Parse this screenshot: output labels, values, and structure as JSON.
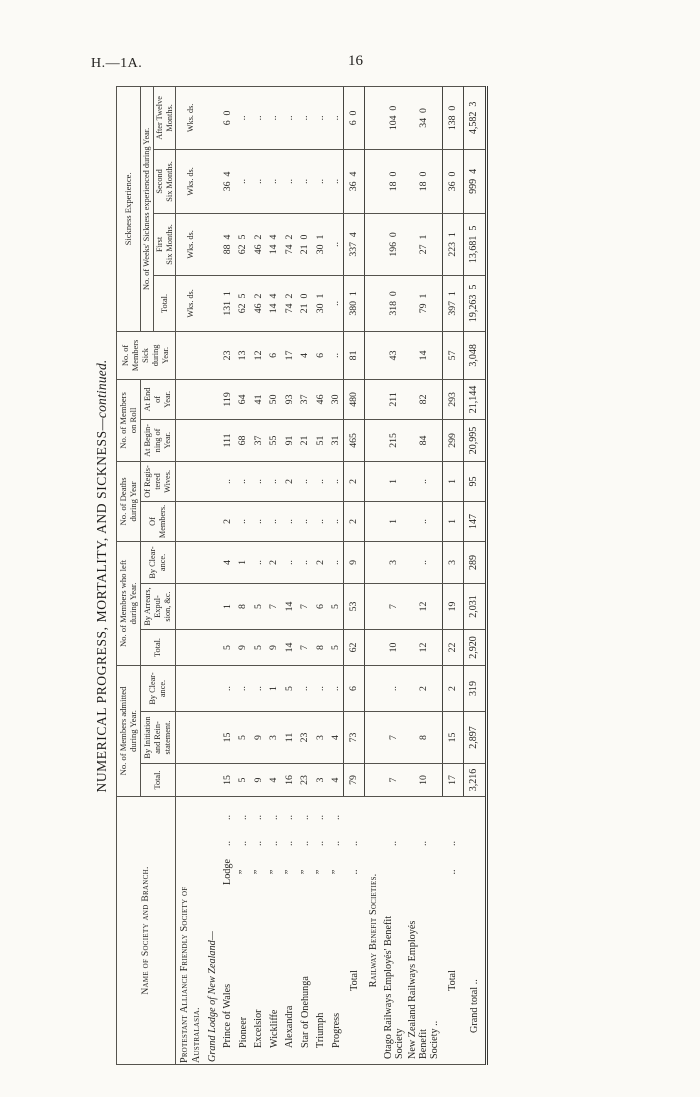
{
  "page": {
    "doc_ref": "H.—1A.",
    "page_number": "16"
  },
  "table": {
    "title_main": "NUMERICAL PROGRESS, MORTALITY, AND SICKNESS",
    "title_suffix": "—continued.",
    "headers": {
      "name": "Name of Society and Branch.",
      "admitted": {
        "group": "No. of Members admitted\nduring Year.",
        "cols": [
          "Total.",
          "By Initiation\nand Rein-\nstatement.",
          "By Clear-\nance."
        ]
      },
      "left": {
        "group": "No. of Members who left\nduring Year.",
        "cols": [
          "Total.",
          "By Arrears,\nExpul-\nsion, &c.",
          "By Clear-\nance."
        ]
      },
      "deaths": {
        "group": "No. of Deaths\nduring Year",
        "cols": [
          "Of\nMembers.",
          "Of Regis-\ntered\nWives."
        ]
      },
      "roll": {
        "group": "No. of Members\non Roll",
        "cols": [
          "At Begin-\nning of\nYear.",
          "At End\nof\nYear."
        ]
      },
      "sick": "No. of\nMembers\nSick\nduring\nYear.",
      "sickness": {
        "group": "Sickness Experience.",
        "subgroup": "No. of Weeks' Sickness experienced during Year.",
        "cols": [
          "Total.",
          "First\nSix Months.",
          "Second\nSix Months.",
          "After Twelve\nMonths."
        ],
        "units": "Wks. ds."
      }
    },
    "rows": [
      {
        "type": "sectionpre",
        "label": "Protestant Alliance Friendly Society of\n                              Australasia.",
        "mid": "",
        "d1": "",
        "d2": "",
        "values": [
          "",
          "",
          "",
          "",
          "",
          "",
          "",
          "",
          "",
          "",
          "",
          "Wks. ds.",
          "Wks. ds.",
          "Wks. ds.",
          "Wks. ds."
        ]
      },
      {
        "type": "italic",
        "label": "Grand Lodge of New Zealand—",
        "mid": "",
        "d1": "",
        "d2": "",
        "values": [
          "",
          "",
          "",
          "",
          "",
          "",
          "",
          "",
          "",
          "",
          "",
          "",
          "",
          "",
          ""
        ]
      },
      {
        "type": "lodge",
        "label": "Prince of Wales",
        "mid": "Lodge",
        "d1": "..",
        "d2": "..",
        "values": [
          "15",
          "15",
          "..",
          "5",
          "1",
          "4",
          "2",
          "..",
          "111",
          "119",
          "23",
          "131  1",
          "88  4",
          "36  4",
          "6  0"
        ]
      },
      {
        "type": "lodge",
        "label": "Pioneer",
        "mid": "”",
        "d1": "..",
        "d2": "..",
        "values": [
          "5",
          "5",
          "..",
          "9",
          "8",
          "1",
          "..",
          "..",
          "68",
          "64",
          "13",
          "62  5",
          "62  5",
          "..",
          ".."
        ]
      },
      {
        "type": "lodge",
        "label": "Excelsior",
        "mid": "”",
        "d1": "..",
        "d2": "..",
        "values": [
          "9",
          "9",
          "..",
          "5",
          "5",
          "..",
          "..",
          "..",
          "37",
          "41",
          "12",
          "46  2",
          "46  2",
          "..",
          ".."
        ]
      },
      {
        "type": "lodge",
        "label": "Wickliffe",
        "mid": "”",
        "d1": "..",
        "d2": "..",
        "values": [
          "4",
          "3",
          "1",
          "9",
          "7",
          "2",
          "..",
          "..",
          "55",
          "50",
          "6",
          "14  4",
          "14  4",
          "..",
          ".."
        ]
      },
      {
        "type": "lodge",
        "label": "Alexandra",
        "mid": "”",
        "d1": "..",
        "d2": "..",
        "values": [
          "16",
          "11",
          "5",
          "14",
          "14",
          "..",
          "..",
          "2",
          "91",
          "93",
          "17",
          "74  2",
          "74  2",
          "..",
          ".."
        ]
      },
      {
        "type": "lodge",
        "label": "Star of Onehunga",
        "mid": "”",
        "d1": "..",
        "d2": "..",
        "values": [
          "23",
          "23",
          "..",
          "7",
          "7",
          "..",
          "..",
          "..",
          "21",
          "37",
          "4",
          "21  0",
          "21  0",
          "..",
          ".."
        ]
      },
      {
        "type": "lodge",
        "label": "Triumph",
        "mid": "”",
        "d1": "..",
        "d2": "..",
        "values": [
          "3",
          "3",
          "..",
          "8",
          "6",
          "2",
          "..",
          "..",
          "51",
          "46",
          "6",
          "30  1",
          "30  1",
          "..",
          ".."
        ]
      },
      {
        "type": "lodge",
        "label": "Progress",
        "mid": "”",
        "d1": "..",
        "d2": "..",
        "values": [
          "4",
          "4",
          "..",
          "5",
          "5",
          "..",
          "..",
          "..",
          "31",
          "30",
          "..",
          "..",
          "..",
          "..",
          ".."
        ]
      },
      {
        "type": "total",
        "label": "Total",
        "mid": "..",
        "d1": "..",
        "d2": "",
        "values": [
          "79",
          "73",
          "6",
          "62",
          "53",
          "9",
          "2",
          "2",
          "465",
          "480",
          "81",
          "380  1",
          "337  4",
          "36  4",
          "6  0"
        ]
      },
      {
        "type": "sectioncenter",
        "label": "Railway Benefit Societies.",
        "mid": "",
        "d1": "",
        "d2": "",
        "values": [
          "",
          "",
          "",
          "",
          "",
          "",
          "",
          "",
          "",
          "",
          "",
          "",
          "",
          "",
          ""
        ]
      },
      {
        "type": "plain",
        "label": "Otago Railways Employés' Benefit Society",
        "mid": "",
        "d1": "..",
        "d2": "",
        "values": [
          "7",
          "7",
          "..",
          "10",
          "7",
          "3",
          "1",
          "1",
          "215",
          "211",
          "43",
          "318  0",
          "196  0",
          "18  0",
          "104  0"
        ]
      },
      {
        "type": "plain2",
        "label": "New Zealand Railways Employés Benefit\n      Society  ..",
        "mid": "",
        "d1": "..",
        "d2": "",
        "values": [
          "10",
          "8",
          "2",
          "12",
          "12",
          "..",
          "..",
          "..",
          "84",
          "82",
          "14",
          "79  1",
          "27  1",
          "18  0",
          "34  0"
        ]
      },
      {
        "type": "total",
        "label": "Total",
        "mid": "..",
        "d1": "..",
        "d2": "",
        "values": [
          "17",
          "15",
          "2",
          "22",
          "19",
          "3",
          "1",
          "1",
          "299",
          "293",
          "57",
          "397  1",
          "223  1",
          "36  0",
          "138  0"
        ]
      },
      {
        "type": "grand",
        "label": "Grand total ..",
        "mid": "",
        "d1": "",
        "d2": "",
        "values": [
          "3,216",
          "2,897",
          "319",
          "2,920",
          "2,031",
          "289",
          "147",
          "95",
          "20,995",
          "21,144",
          "3,048",
          "19,263  5",
          "13,681  5",
          "999  4",
          "4,582  3"
        ]
      }
    ]
  }
}
